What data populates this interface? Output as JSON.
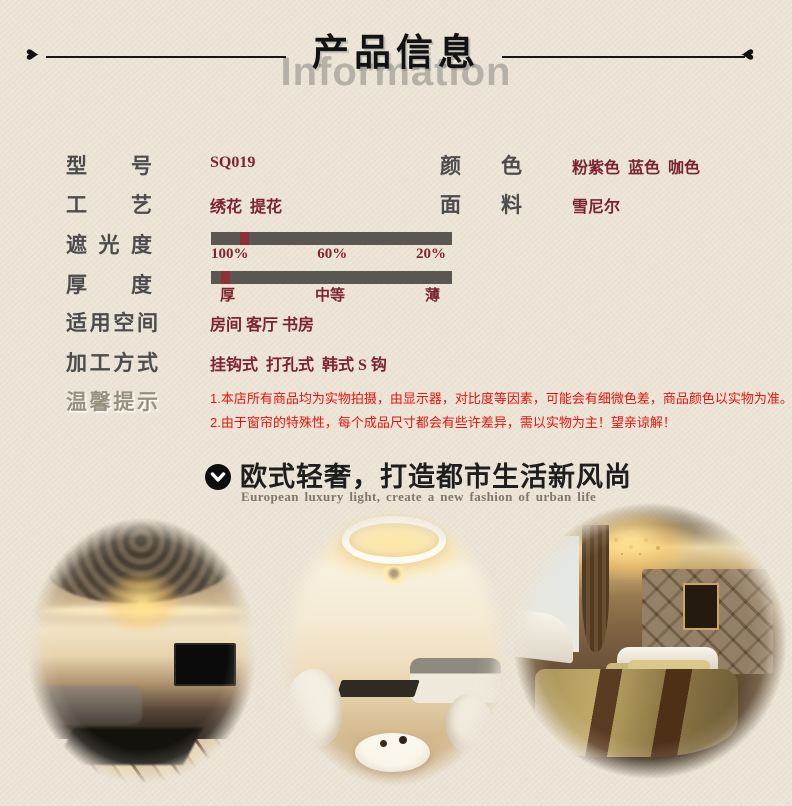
{
  "header": {
    "title": "产品信息",
    "watermark": "Information",
    "heart_glyph": "♥"
  },
  "specs": {
    "model": {
      "label": "型号",
      "value": "SQ019"
    },
    "color": {
      "label": "颜色",
      "value": "粉紫色  蓝色  咖色"
    },
    "craft": {
      "label": "工艺",
      "value": "绣花  提花"
    },
    "fabric": {
      "label": "面料",
      "value": "雪尼尔"
    },
    "shading": {
      "label": "遮光度",
      "ticks": [
        "100%",
        "60%",
        "20%"
      ],
      "marker_left_pct": 12
    },
    "thickness": {
      "label": "厚度",
      "ticks": [
        "厚",
        "中等",
        "薄"
      ],
      "marker_left_pct": 4.3
    },
    "space": {
      "label": "适用空间",
      "value": "房间 客厅 书房"
    },
    "processing": {
      "label": "加工方式",
      "value": "挂钩式  打孔式  韩式 S 钩"
    },
    "tips": {
      "label": "温馨提示",
      "lines": [
        "1.本店所有商品均为实物拍摄，由显示器，对比度等因素，可能会有细微色差，商品颜色以实物为准。",
        "2.由于窗帘的特殊性，每个成品尺寸都会有些许差异，需以实物为主！望亲谅解！"
      ]
    }
  },
  "banner": {
    "title": "欧式轻奢，打造都市生活新风尚",
    "subtitle": "European luxury light, create a new fashion of urban life"
  },
  "gallery": {
    "photos": [
      "european-living-room",
      "bright-living-room",
      "luxury-bedroom"
    ]
  },
  "colors": {
    "page_background": "#ece4d6",
    "label_gray": "#4c4c4c",
    "value_maroon": "#7c2230",
    "tip_red": "#e8140c",
    "bar_gray": "#5a5650",
    "bar_marker_red": "#8e2f3a",
    "watermark_gray": "#b5b1a8"
  }
}
